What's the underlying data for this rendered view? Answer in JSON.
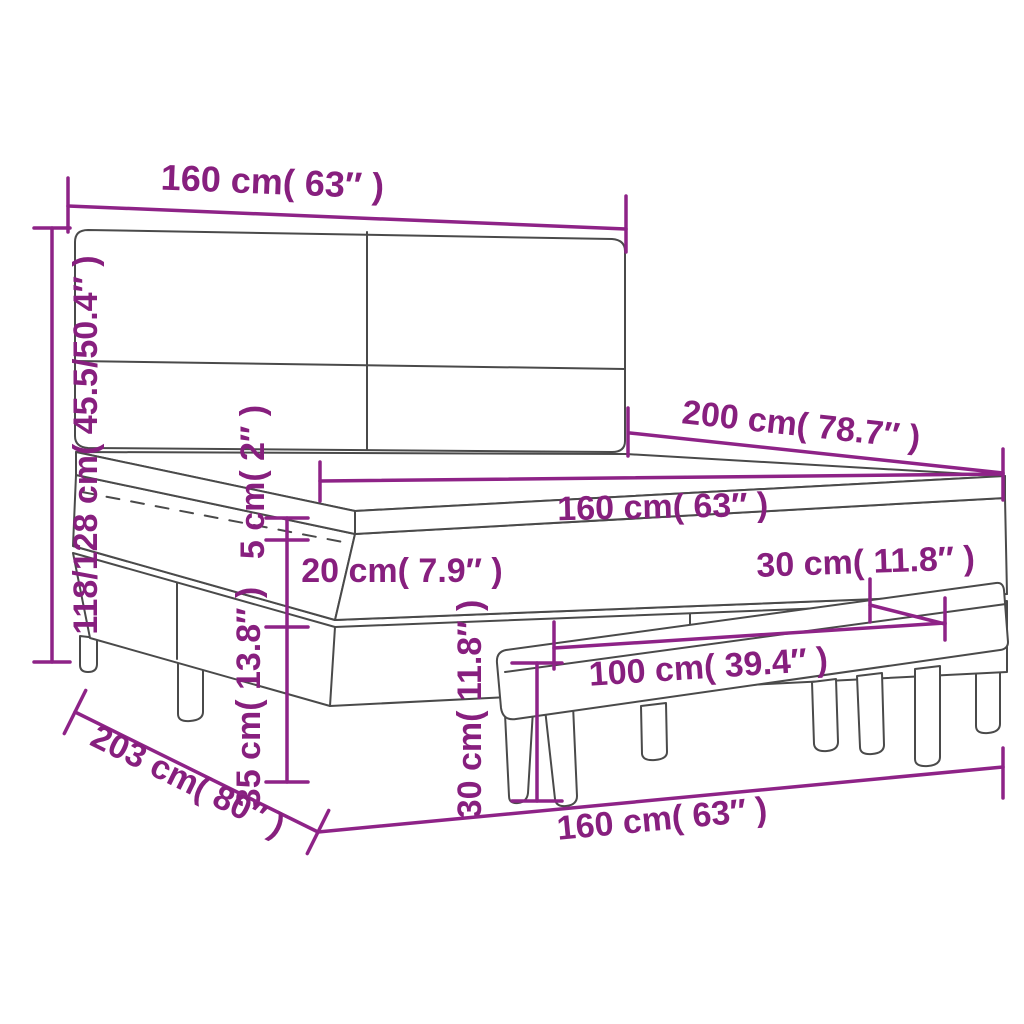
{
  "diagram_type": "furniture-dimension-diagram",
  "colors": {
    "dimension_line": "#8e2387",
    "label_text": "#871f7e",
    "drawing_line": "#4a4a4a",
    "background": "#ffffff"
  },
  "dims": {
    "headboard_width": {
      "label": "160 cm( 63″ )"
    },
    "overall_height": {
      "label": "118/128 cm( 45.5/50.4″ )"
    },
    "bed_length": {
      "label": "200 cm( 78.7″ )"
    },
    "mattress_width": {
      "label": "160 cm( 63″ )"
    },
    "topper_height": {
      "label": "5 cm( 2″ )"
    },
    "mattress_height": {
      "label": "20 cm( 7.9″ )"
    },
    "base_height": {
      "label": "35 cm( 13.8″ )"
    },
    "bench_depth": {
      "label": "30 cm( 11.8″ )"
    },
    "bench_height": {
      "label": "30 cm( 11.8″ )"
    },
    "bench_width": {
      "label": "100 cm( 39.4″ )"
    },
    "frame_length": {
      "label": "203 cm( 80″ )"
    },
    "bed_width_bottom": {
      "label": "160 cm( 63″ )"
    }
  }
}
